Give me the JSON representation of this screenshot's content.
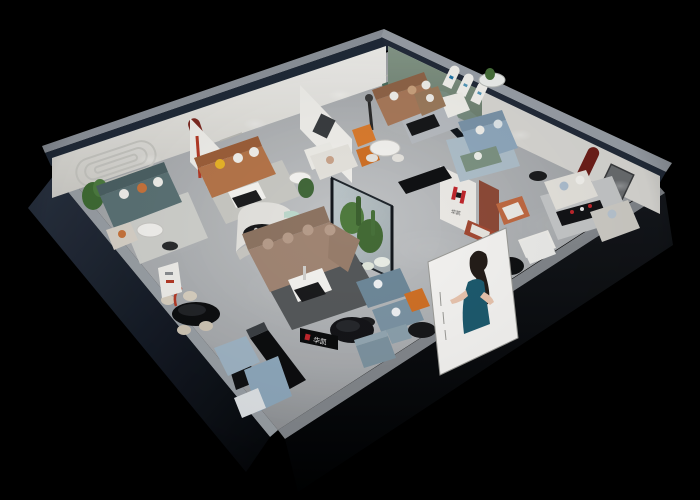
{
  "scene": {
    "title": "3D isometric cutaway render of a furniture brand showroom",
    "background_color": "#000000",
    "brand": {
      "name": "华凯",
      "logo_letter": "H",
      "logo_red": "#c0272d",
      "logo_dark": "#17181a"
    },
    "palette": {
      "exterior_wall": "#1e2836",
      "wall_edge_highlight": "#9aa0a8",
      "interior_wall": "#e9e8e4",
      "floor_light": "#c2c4c6",
      "floor_dark": "#85888c",
      "accent_green_wall": "#7f937f",
      "accent_red_niche": "#7a241c",
      "sofa_teal": "#5b7275",
      "sofa_caramel": "#b5754a",
      "sofa_taupe": "#a08573",
      "sofa_blue": "#8fa8bd",
      "sofa_tan": "#a8795a",
      "sofa_light_blue": "#9db4c6",
      "accent_orange": "#d97b2e",
      "mint_bench": "#bcd8cc",
      "atrium_green": "#4f7a3e",
      "banner_dress_teal": "#1d5a6e"
    },
    "rooms": [
      {
        "id": "room-a",
        "name": "teal sofa lounge",
        "items": [
          "grooved wall panel",
          "teal fabric sofa",
          "white round coffee table",
          "green plant",
          "beige armchair",
          "striped rug"
        ]
      },
      {
        "id": "room-b",
        "name": "caramel leather lounge",
        "items": [
          "red arched wall niche",
          "caramel sectional sofa",
          "yellow pillow",
          "black-white coffee table",
          "white armchair",
          "red floor lamp"
        ]
      },
      {
        "id": "room-c",
        "name": "tan sofa studio",
        "items": [
          "green wall sign",
          "tan leather sofa",
          "black coffee table",
          "orange accent chairs",
          "white desk set",
          "sculpture lamp"
        ]
      },
      {
        "id": "room-d",
        "name": "green arch gallery",
        "items": [
          "sage green wall",
          "three white arch panels",
          "white armchair",
          "brown sofa",
          "glass round table"
        ]
      },
      {
        "id": "room-e",
        "name": "blue sofa room",
        "items": [
          "glass partition",
          "light blue sofa",
          "green bench",
          "blue rug"
        ]
      },
      {
        "id": "room-f",
        "name": "right showroom",
        "items": [
          "tall red arch niche",
          "picture frame",
          "white sofa",
          "black display rack",
          "grey sofa",
          "orange frame chair",
          "white bench"
        ]
      },
      {
        "id": "center",
        "name": "central hall",
        "items": [
          "curved white partition",
          "black oval table",
          "mint curved bench",
          "taupe sectional sofa",
          "white coffee table",
          "glass plant atrium",
          "blue sofa pair",
          "brand logo wall"
        ]
      },
      {
        "id": "entry",
        "name": "entry / reception",
        "items": [
          "black reception desk",
          "illuminated brand logo",
          "blue-grey ottomans",
          "black dining table with cream chairs",
          "red arc floor lamp",
          "media benches",
          "blue rugs",
          "white ottoman",
          "promo banner with model in teal dress"
        ]
      }
    ]
  }
}
